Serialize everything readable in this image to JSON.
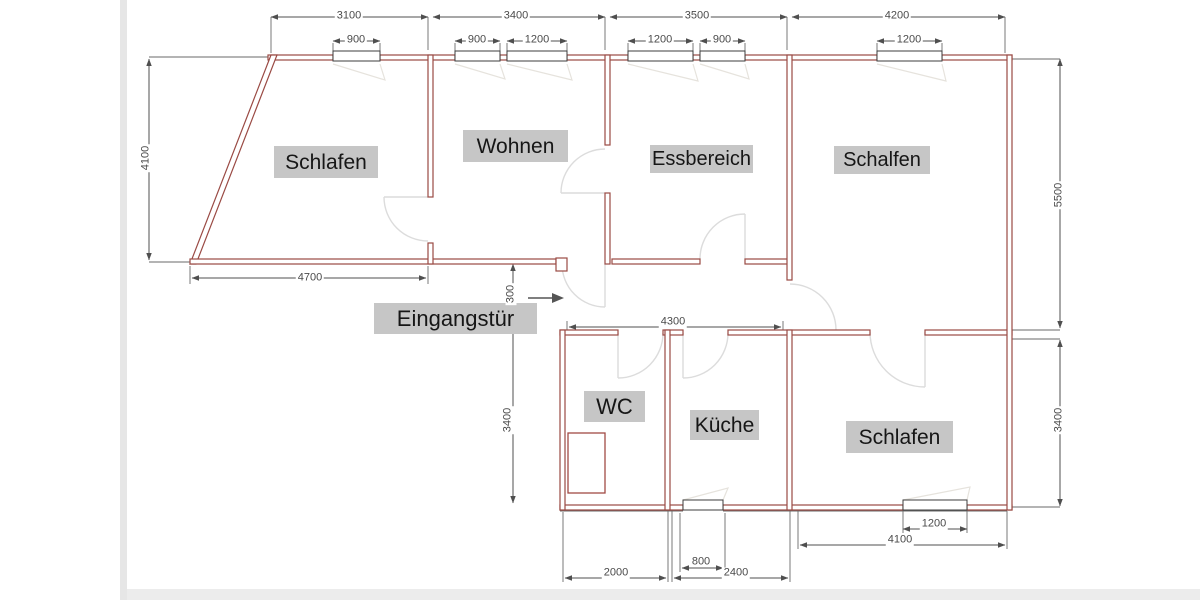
{
  "drawing": {
    "type": "floor-plan",
    "colors": {
      "wall": "#9a4a44",
      "window_frame": "#3c3c3c",
      "dimension_line": "#4f4f4f",
      "door_arc": "#dcdcdc",
      "window_swing": "#e6e3dd",
      "label_background": "#c6c6c6",
      "label_text": "#161616",
      "page_edge": "#e6e6e6"
    }
  },
  "rooms": {
    "schlafen_left": "Schlafen",
    "wohnen": "Wohnen",
    "essbereich": "Essbereich",
    "schalfen_right": "Schalfen",
    "wc": "WC",
    "kueche": "Küche",
    "schlafen_bottom": "Schlafen"
  },
  "entrance_label": "Eingangstür",
  "dims": {
    "top_schlafen": "3100",
    "top_wohnen": "3400",
    "top_essbereich": "3500",
    "top_schalfen": "4200",
    "win_schlafen": "900",
    "win_wohnen_1": "900",
    "win_wohnen_2": "1200",
    "win_essbereich_1": "1200",
    "win_essbereich_2": "900",
    "win_schalfen": "1200",
    "left_schlafen_height": "4100",
    "schlafen_bottom_width": "4700",
    "entrance_offset": "300",
    "corridor_width": "4300",
    "right_upper_height": "5500",
    "right_lower_height": "3400",
    "wc_kueche_height": "3400",
    "schlafen_b_window": "1200",
    "schlafen_b_width": "4100",
    "kueche_window": "800",
    "wc_width": "2000",
    "kueche_width": "2400"
  }
}
